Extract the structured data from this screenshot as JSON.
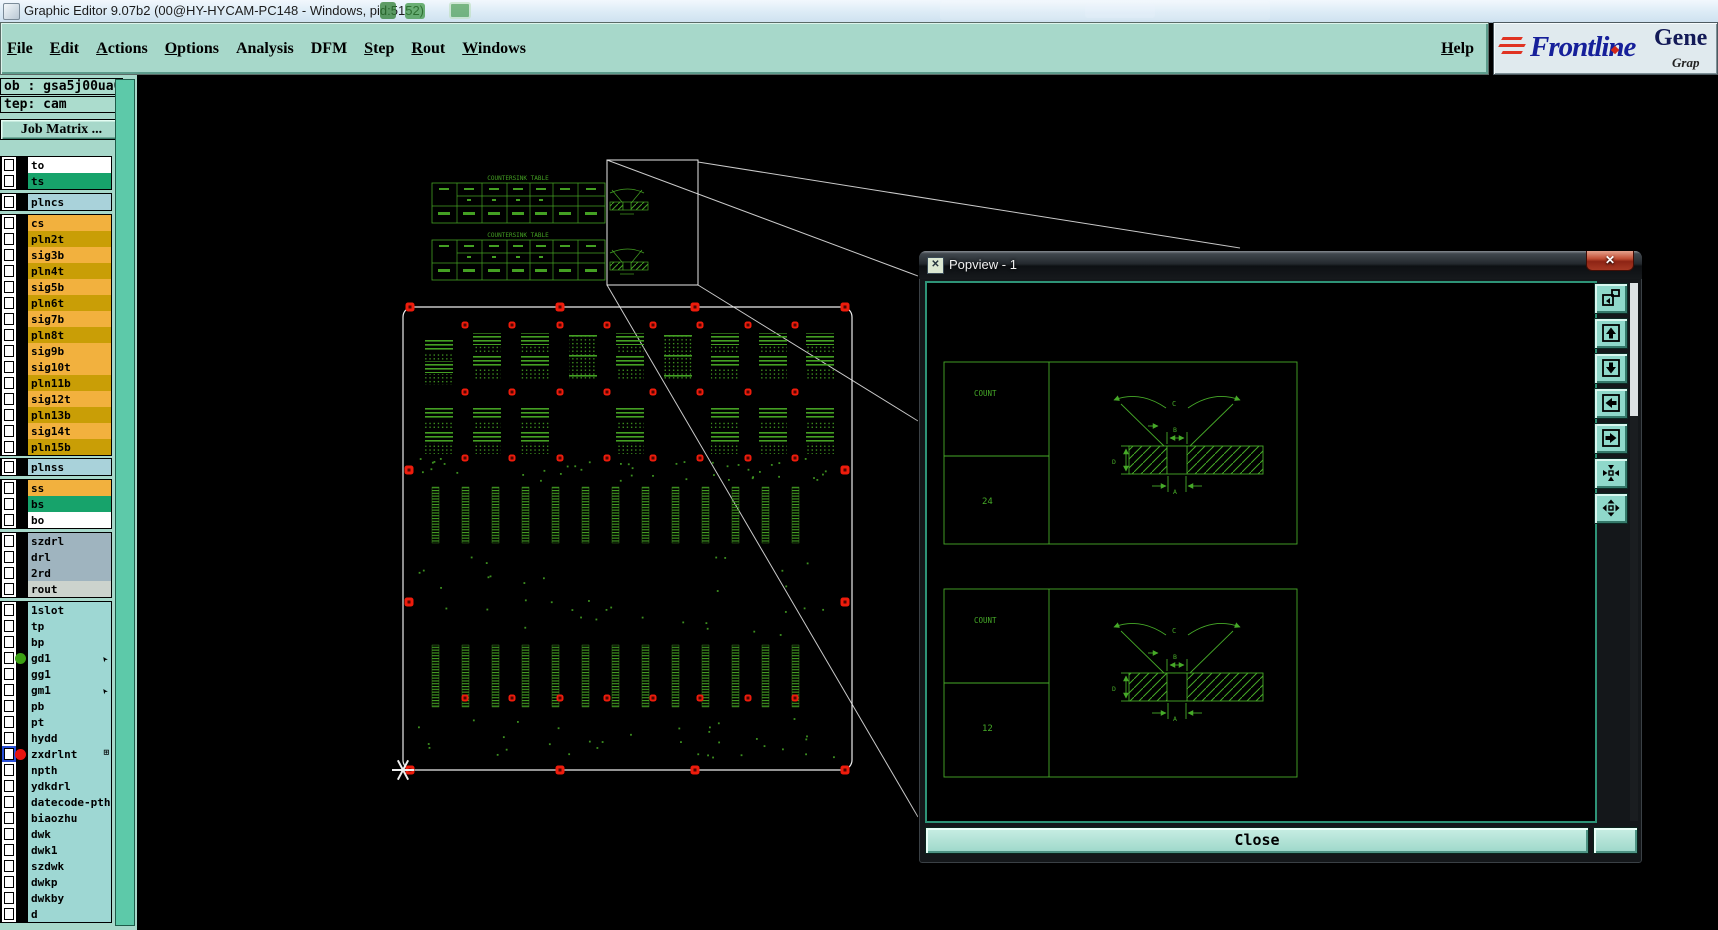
{
  "window": {
    "title": "Graphic Editor 9.07b2 (00@HY-HYCAM-PC148 - Windows, pid:5152)"
  },
  "menu": {
    "items": [
      {
        "label": "File",
        "u": true
      },
      {
        "label": "Edit",
        "u": true
      },
      {
        "label": "Actions",
        "u": true
      },
      {
        "label": "Options",
        "u": true
      },
      {
        "label": "Analysis",
        "u": false
      },
      {
        "label": "DFM",
        "u": false
      },
      {
        "label": "Step",
        "u": true
      },
      {
        "label": "Rout",
        "u": true
      },
      {
        "label": "Windows",
        "u": true
      }
    ],
    "help": "Help"
  },
  "brand": {
    "name": "Frontline",
    "product": "Gene",
    "tagline": "Grap"
  },
  "job": {
    "job_label": "ob : gsa5j00ua0",
    "step_label": "tep: cam",
    "matrix_button": "Job Matrix ..."
  },
  "layers": {
    "groups": [
      {
        "rows": [
          {
            "name": "to",
            "bg": "#ffffff"
          },
          {
            "name": "ts",
            "bg": "#17a36b"
          }
        ]
      },
      {
        "rows": [
          {
            "name": "plncs",
            "bg": "#a9d2da"
          }
        ]
      },
      {
        "rows": [
          {
            "name": "cs",
            "bg": "#f2b13e"
          },
          {
            "name": "pln2t",
            "bg": "#c99e06"
          },
          {
            "name": "sig3b",
            "bg": "#f2b13e"
          },
          {
            "name": "pln4t",
            "bg": "#c99e06"
          },
          {
            "name": "sig5b",
            "bg": "#f2b13e"
          },
          {
            "name": "pln6t",
            "bg": "#c99e06"
          },
          {
            "name": "sig7b",
            "bg": "#f2b13e"
          },
          {
            "name": "pln8t",
            "bg": "#c99e06"
          },
          {
            "name": "sig9b",
            "bg": "#f2b13e"
          },
          {
            "name": "sig10t",
            "bg": "#f2b13e"
          },
          {
            "name": "pln11b",
            "bg": "#c99e06"
          },
          {
            "name": "sig12t",
            "bg": "#f2b13e"
          },
          {
            "name": "pln13b",
            "bg": "#c99e06"
          },
          {
            "name": "sig14t",
            "bg": "#f2b13e"
          },
          {
            "name": "pln15b",
            "bg": "#c99e06"
          }
        ]
      },
      {
        "rows": [
          {
            "name": "plnss",
            "bg": "#a9d2da"
          }
        ]
      },
      {
        "rows": [
          {
            "name": "ss",
            "bg": "#f2b13e"
          },
          {
            "name": "bs",
            "bg": "#17a36b"
          },
          {
            "name": "bo",
            "bg": "#ffffff"
          }
        ]
      },
      {
        "rows": [
          {
            "name": "szdrl",
            "bg": "#9fb4bf"
          },
          {
            "name": "drl",
            "bg": "#9fb4bf"
          },
          {
            "name": "2rd",
            "bg": "#9fb4bf"
          },
          {
            "name": "rout",
            "bg": "#ccd3cd"
          }
        ]
      },
      {
        "rows": [
          {
            "name": "1slot",
            "bg": "#9ed7d3"
          },
          {
            "name": "tp",
            "bg": "#9ed7d3"
          },
          {
            "name": "bp",
            "bg": "#9ed7d3"
          },
          {
            "name": "gd1",
            "bg": "#9ed7d3",
            "dot": "#3ba014",
            "marker": "arrow"
          },
          {
            "name": "gg1",
            "bg": "#9ed7d3"
          },
          {
            "name": "gm1",
            "bg": "#9ed7d3",
            "marker": "arrow"
          },
          {
            "name": "pb",
            "bg": "#9ed7d3"
          },
          {
            "name": "pt",
            "bg": "#9ed7d3"
          },
          {
            "name": "hydd",
            "bg": "#9ed7d3"
          },
          {
            "name": "zxdrlnt",
            "bg": "#9ed7d3",
            "dot": "#e81410",
            "marker": "grid",
            "selected": true
          },
          {
            "name": "npth",
            "bg": "#9ed7d3"
          },
          {
            "name": "ydkdrl",
            "bg": "#9ed7d3"
          },
          {
            "name": "datecode-pth",
            "bg": "#9ed7d3"
          },
          {
            "name": "biaozhu",
            "bg": "#9ed7d3"
          },
          {
            "name": "dwk",
            "bg": "#9ed7d3"
          },
          {
            "name": "dwk1",
            "bg": "#9ed7d3"
          },
          {
            "name": "szdwk",
            "bg": "#9ed7d3"
          },
          {
            "name": "dwkp",
            "bg": "#9ed7d3"
          },
          {
            "name": "dwkby",
            "bg": "#9ed7d3"
          },
          {
            "name": "d",
            "bg": "#9ed7d3"
          }
        ]
      }
    ]
  },
  "canvas": {
    "tables": [
      {
        "title": "COUNTERSINK TABLE"
      },
      {
        "title": "COUNTERSINK TABLE"
      }
    ]
  },
  "popview": {
    "title": "Popview - 1",
    "close_x": "✕",
    "close_label": "Close",
    "panels": [
      {
        "count_label": "COUNT",
        "count_value": "24",
        "dim_angle": "C",
        "dim_top": "B",
        "dim_depth": "D",
        "dim_bottom": "A"
      },
      {
        "count_label": "COUNT",
        "count_value": "12",
        "dim_angle": "C",
        "dim_top": "B",
        "dim_depth": "D",
        "dim_bottom": "A"
      }
    ],
    "tools": [
      "popout",
      "pan-up",
      "pan-down",
      "pan-left",
      "pan-right",
      "fit-in",
      "fit-out"
    ]
  },
  "colors": {
    "ui_teal": "#a7d8ca",
    "canvas_green": "#44a023",
    "popview_green": "#46aa28",
    "dot_red": "#ee1c0c",
    "brand_navy": "#16209a"
  }
}
